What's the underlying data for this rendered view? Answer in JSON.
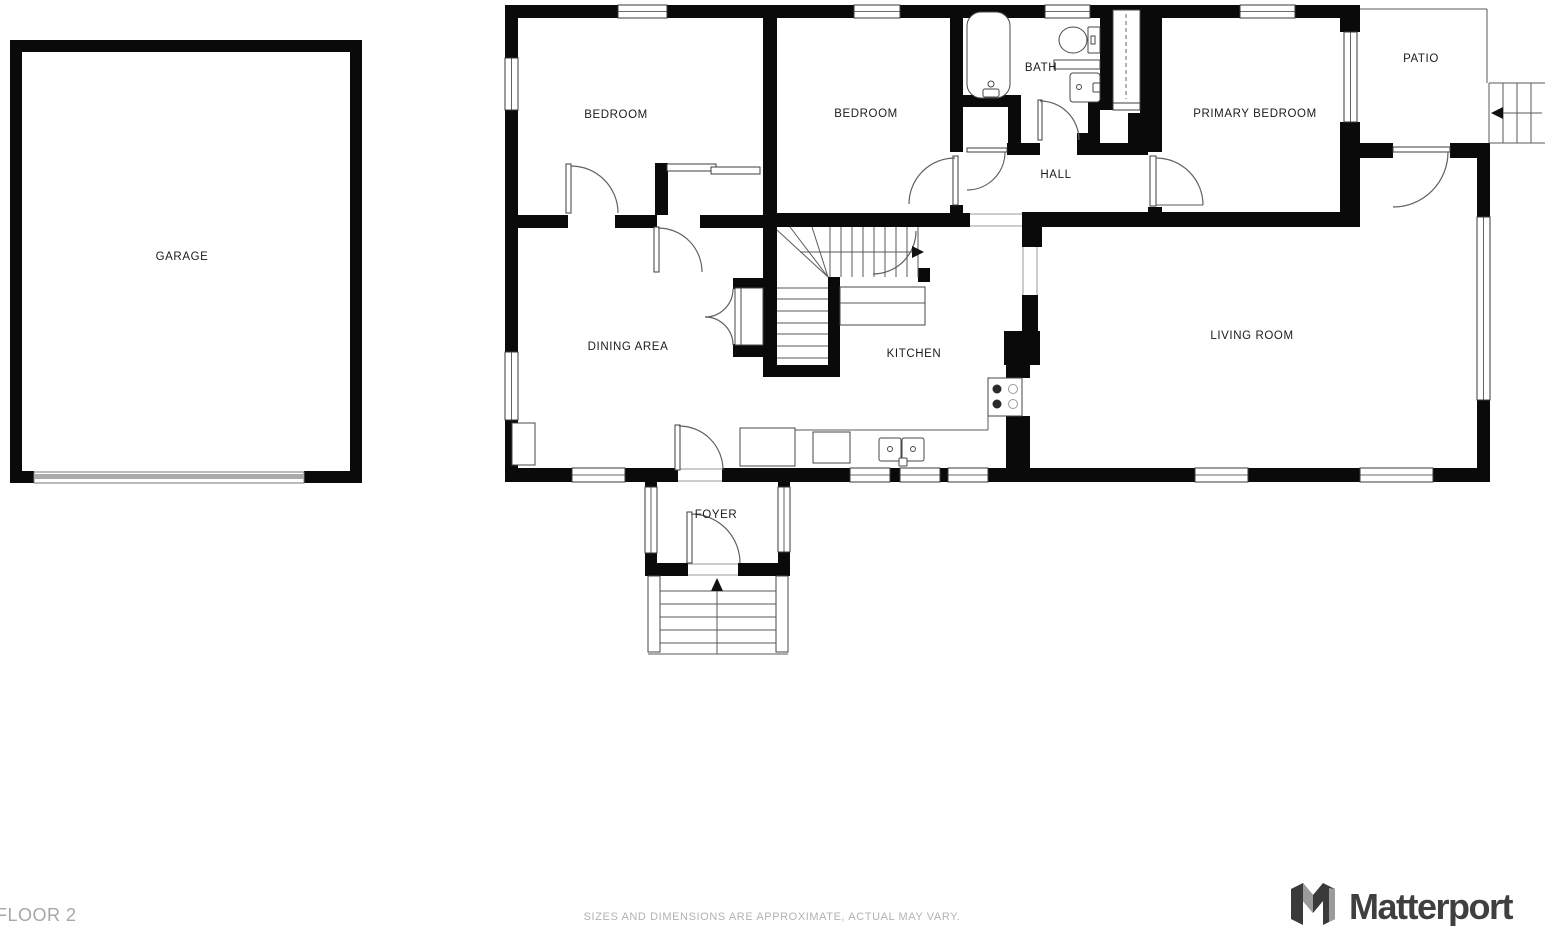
{
  "floorplan": {
    "rooms": [
      {
        "id": "garage",
        "label": "GARAGE"
      },
      {
        "id": "bedroom1",
        "label": "BEDROOM"
      },
      {
        "id": "bedroom2",
        "label": "BEDROOM"
      },
      {
        "id": "bath",
        "label": "BATH"
      },
      {
        "id": "primary-bedroom",
        "label": "PRIMARY BEDROOM"
      },
      {
        "id": "patio",
        "label": "PATIO"
      },
      {
        "id": "hall",
        "label": "HALL"
      },
      {
        "id": "dining-area",
        "label": "DINING AREA"
      },
      {
        "id": "kitchen",
        "label": "KITCHEN"
      },
      {
        "id": "living-room",
        "label": "LIVING ROOM"
      },
      {
        "id": "foyer",
        "label": "FOYER"
      }
    ],
    "colors": {
      "wall": "#0a0a0a",
      "fixture_line": "#474747",
      "label_text": "#1b1b1b",
      "footer_text": "#a7a7a7",
      "garage_door": "#aaaaaa"
    }
  },
  "footer": {
    "floor_label": "FLOOR 2",
    "disclaimer": "SIZES AND DIMENSIONS ARE APPROXIMATE, ACTUAL MAY VARY.",
    "brand": "Matterport"
  }
}
